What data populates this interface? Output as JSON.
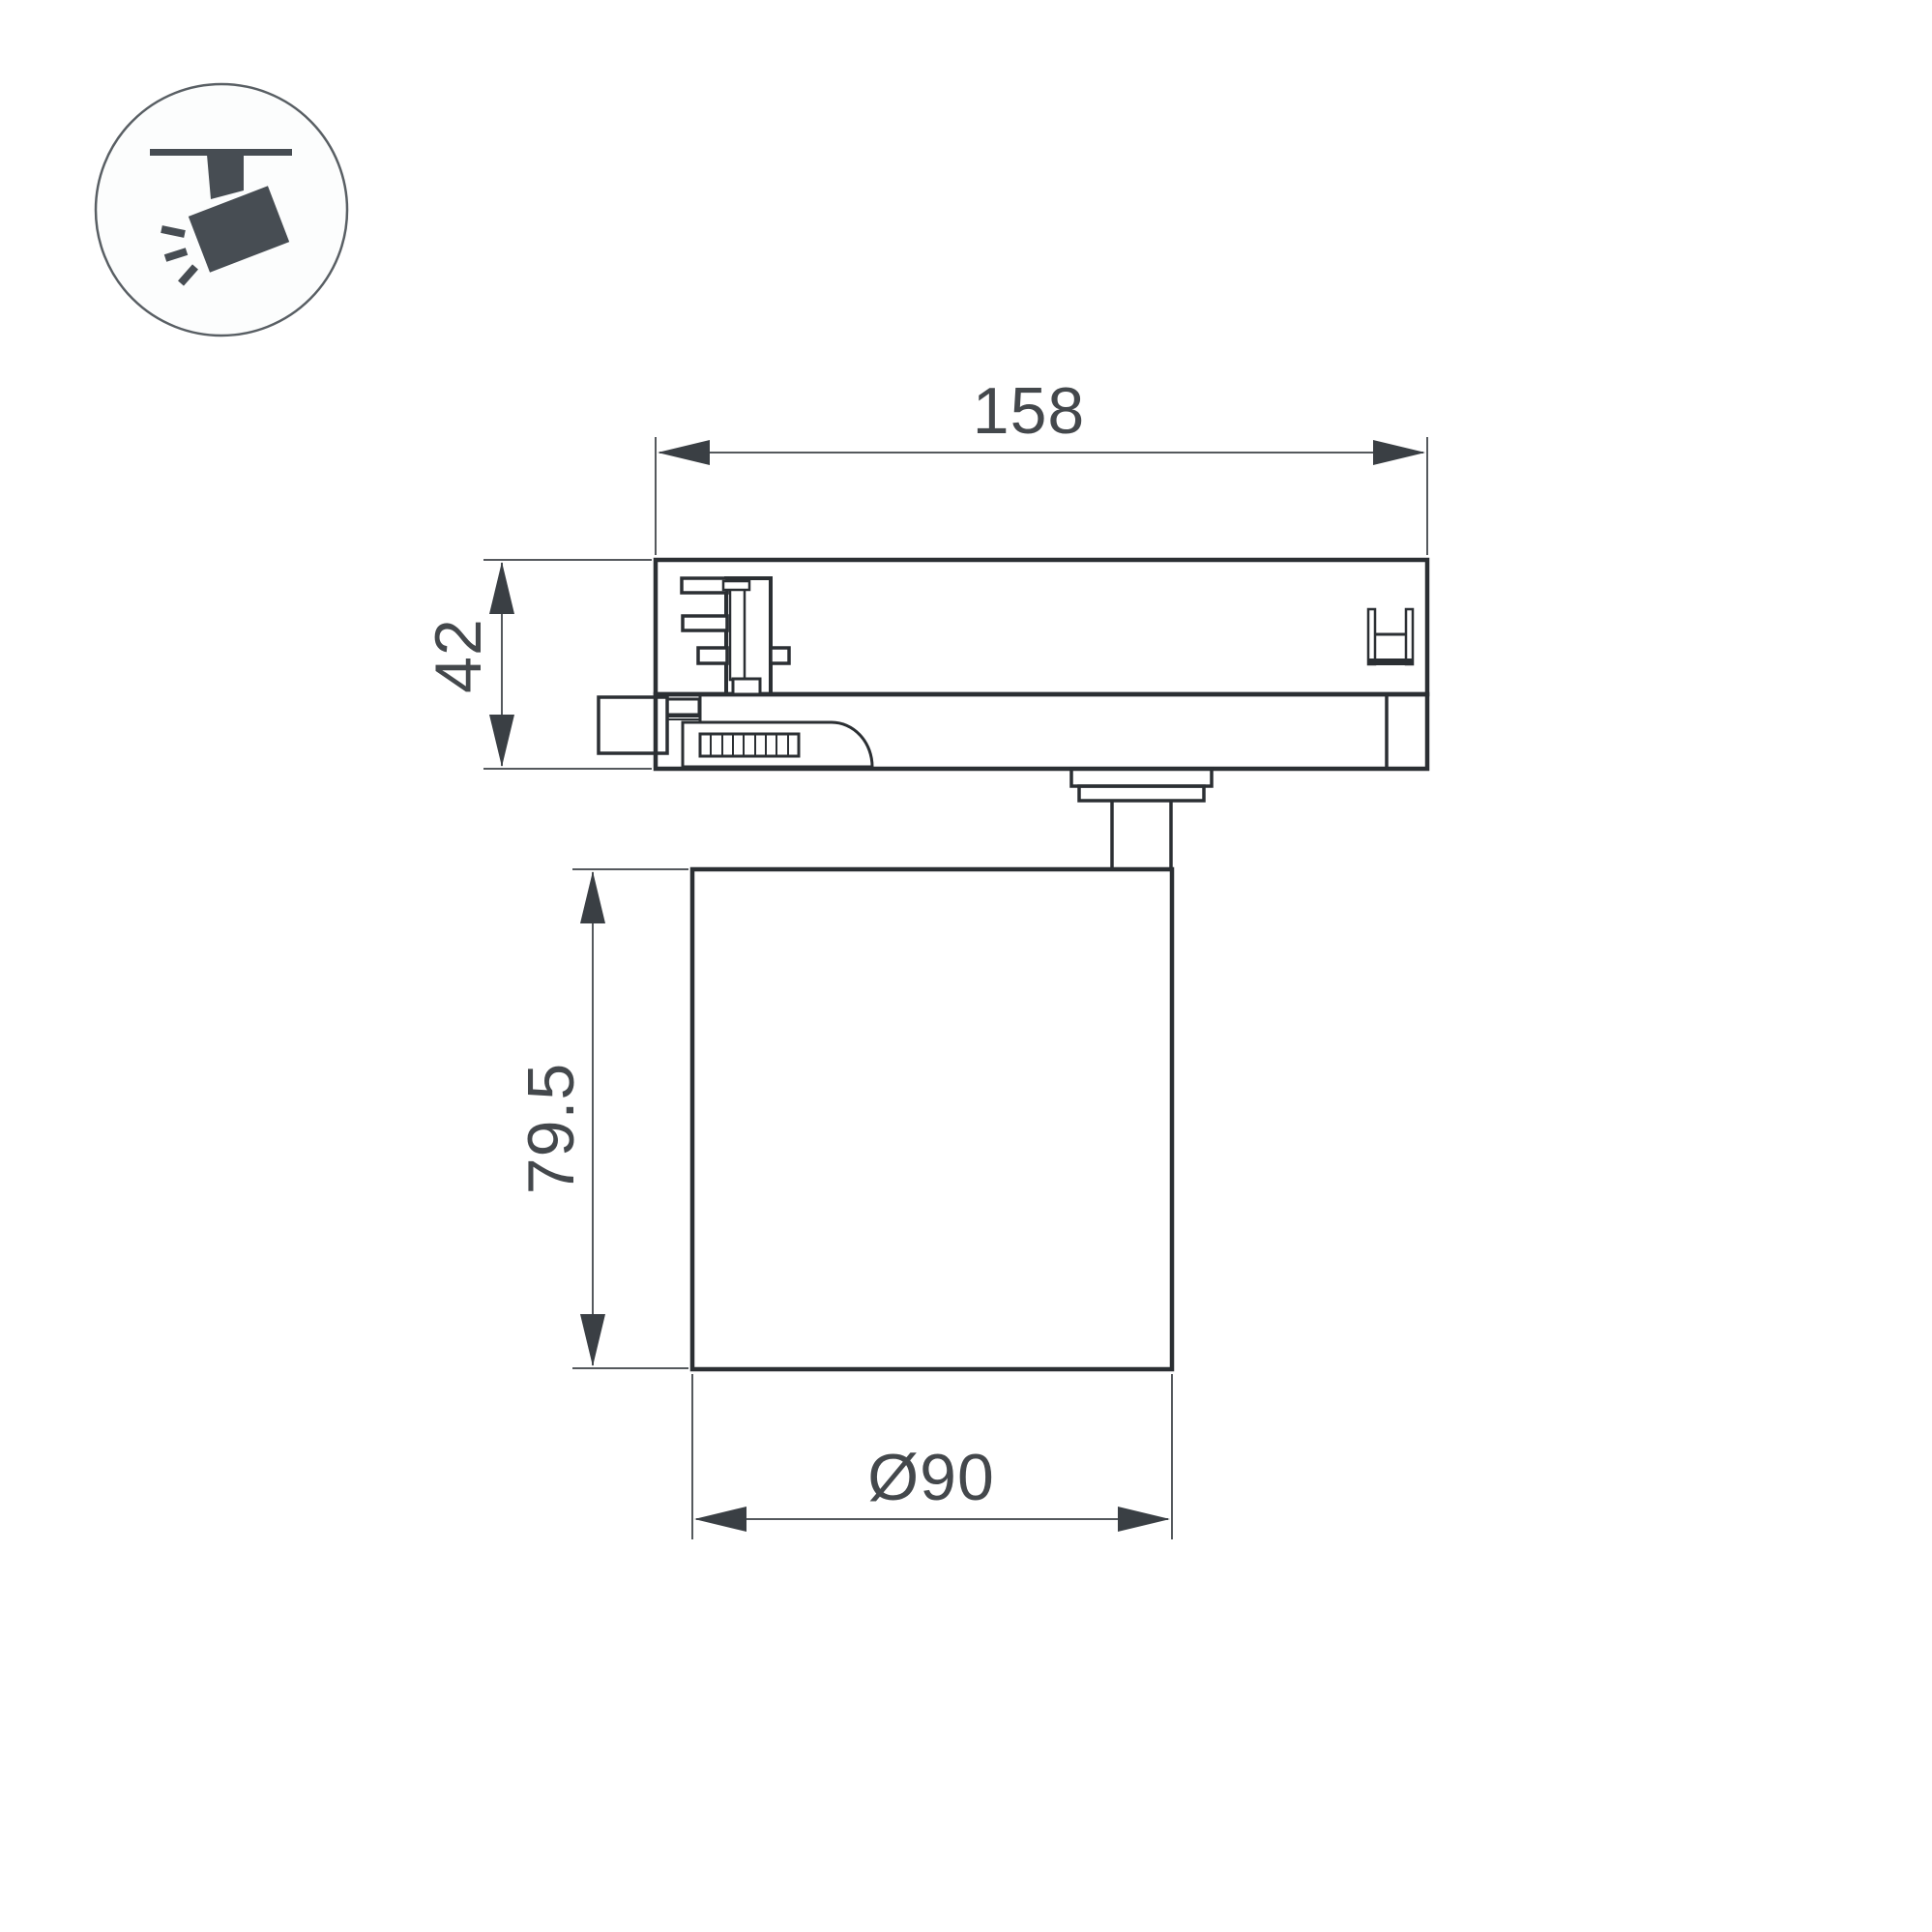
{
  "drawing": {
    "kind": "technical-dimension-drawing",
    "subject": "track-spotlight-side-view",
    "dimensions": {
      "track_length": "158",
      "adapter_height": "42",
      "body_height": "79.5",
      "body_diameter": "Ø90"
    }
  },
  "icon": {
    "name": "track-spotlight",
    "glyph_color": "#474d53",
    "circle_stroke": "#595f64"
  },
  "colors": {
    "background": "#ffffff",
    "object_line": "#2b2f33",
    "dimension_line": "#55595d",
    "dimension_text": "#44484c"
  }
}
